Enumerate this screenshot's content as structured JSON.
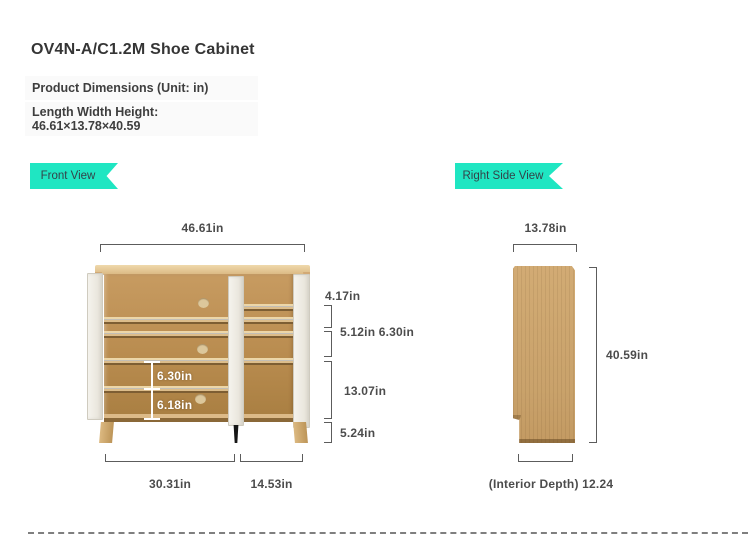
{
  "header": {
    "title": "OV4N-A/C1.2M Shoe Cabinet",
    "unit_line": "Product Dimensions (Unit: in)",
    "size_label": "Length Width Height:",
    "size_value": "46.61×13.78×40.59"
  },
  "front_view": {
    "badge_label": "Front View",
    "dims": {
      "top_width": "46.61in",
      "seg_top": "4.17in",
      "seg_row": "5.12in 6.30in",
      "seg_mid": "13.07in",
      "seg_bottom": "5.24in",
      "inner_upper": "6.30in",
      "inner_lower": "6.18in",
      "bottom_left": "30.31in",
      "bottom_right": "14.53in"
    }
  },
  "side_view": {
    "badge_label": "Right Side View",
    "dims": {
      "top_width": "13.78in",
      "height": "40.59in",
      "interior_depth": "(Interior Depth) 12.24"
    }
  },
  "colors": {
    "accent_teal": "#1fe6c2",
    "badge_text": "#344349",
    "wood_light": "#ecd6a8",
    "wood_mid": "#c79b61",
    "wood_dark": "#a87e41",
    "door_white": "#f3f1ea",
    "dimension_line": "#5c5c5c",
    "dimension_text": "#4c4c4c"
  }
}
